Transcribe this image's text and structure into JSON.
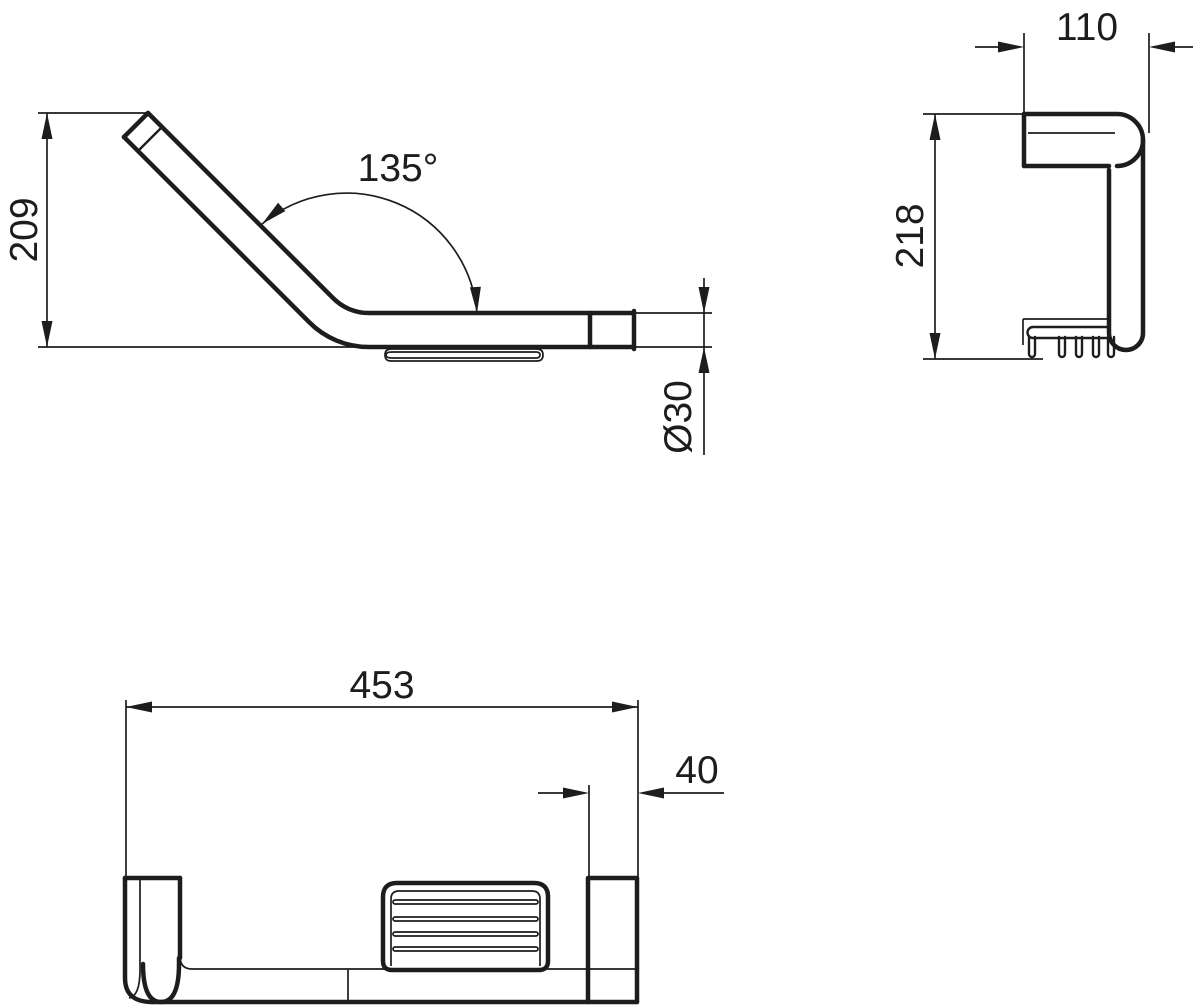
{
  "drawing": {
    "side_view": {
      "height": "209",
      "angle": "135°",
      "diameter": "Ø30"
    },
    "end_view": {
      "depth": "110",
      "height": "218"
    },
    "plan_view": {
      "length": "453",
      "end_offset": "40"
    },
    "colors": {
      "line": "#1d1d1b",
      "background": "#ffffff"
    }
  }
}
